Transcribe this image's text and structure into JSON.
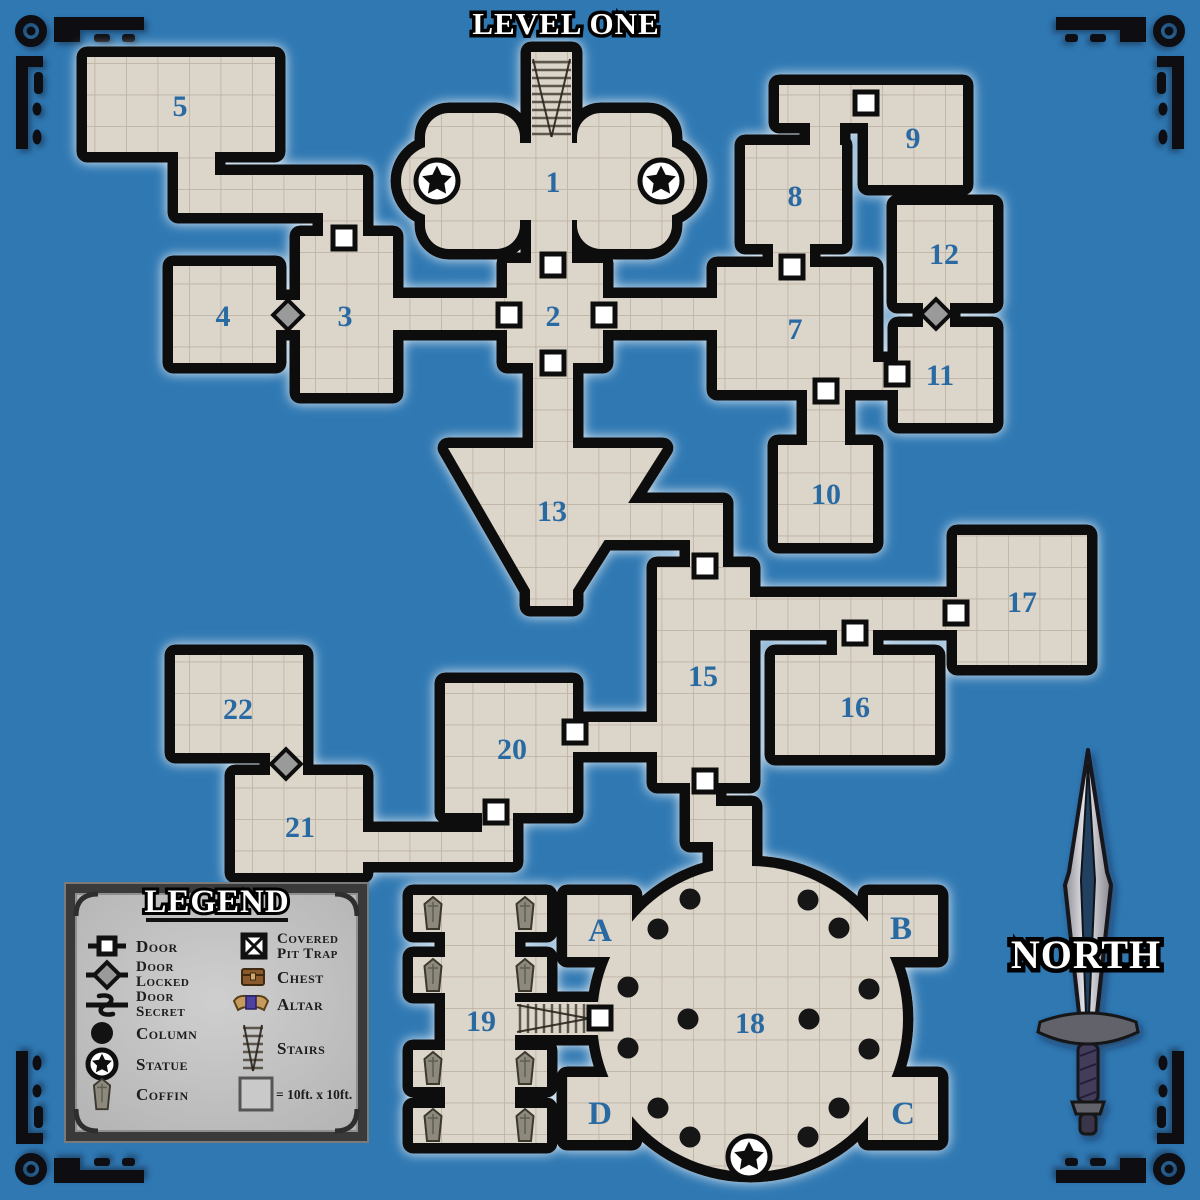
{
  "title": "LEVEL ONE",
  "compass": {
    "label": "NORTH"
  },
  "legend": {
    "title": "LEGEND",
    "items": [
      {
        "name": "door",
        "label": "Door"
      },
      {
        "name": "door-locked",
        "label": "Door Locked",
        "line1": "Door",
        "line2": "Locked"
      },
      {
        "name": "door-secret",
        "label": "Door Secret",
        "line1": "Door",
        "line2": "Secret"
      },
      {
        "name": "column",
        "label": "Column"
      },
      {
        "name": "statue",
        "label": "Statue"
      },
      {
        "name": "coffin",
        "label": "Coffin"
      },
      {
        "name": "covered-pit-trap",
        "label": "Covered Pit Trap",
        "line1": "Covered",
        "line2": "Pit Trap"
      },
      {
        "name": "chest",
        "label": "Chest"
      },
      {
        "name": "altar",
        "label": "Altar"
      },
      {
        "name": "stairs",
        "label": "Stairs"
      },
      {
        "name": "scale",
        "label": "= 10ft. x 10ft."
      }
    ]
  },
  "rooms": {
    "r1": "1",
    "r2": "2",
    "r3": "3",
    "r4": "4",
    "r5": "5",
    "r7": "7",
    "r8": "8",
    "r9": "9",
    "r10": "10",
    "r11": "11",
    "r12": "12",
    "r13": "13",
    "r15": "15",
    "r16": "16",
    "r17": "17",
    "r18": "18",
    "r19": "19",
    "r20": "20",
    "r21": "21",
    "r22": "22",
    "rA": "A",
    "rB": "B",
    "rC": "C",
    "rD": "D"
  },
  "colors": {
    "bg": "#2f78b2",
    "floor": "#dcd5c9",
    "grid": "#b9ae9f",
    "wall": "#111111",
    "room-number": "#2b6ba3",
    "door-fill": "#ffffff",
    "locked-fill": "#9a9a9a",
    "legend-bg": "#c6c6c6",
    "legend-text": "#1d1d1d"
  },
  "map_features": {
    "doors": [
      [
        344,
        238
      ],
      [
        553,
        265
      ],
      [
        509,
        315
      ],
      [
        604,
        315
      ],
      [
        553,
        363
      ],
      [
        792,
        267
      ],
      [
        866,
        103
      ],
      [
        897,
        374
      ],
      [
        826,
        391
      ],
      [
        705,
        566
      ],
      [
        956,
        613
      ],
      [
        855,
        633
      ],
      [
        705,
        781
      ],
      [
        575,
        732
      ],
      [
        496,
        812
      ],
      [
        600,
        1018
      ]
    ],
    "locked_doors": [
      [
        288,
        315
      ],
      [
        936,
        314
      ],
      [
        286,
        764
      ]
    ],
    "columns": [
      [
        690,
        899
      ],
      [
        808,
        900
      ],
      [
        658,
        929
      ],
      [
        839,
        928
      ],
      [
        628,
        987
      ],
      [
        869,
        989
      ],
      [
        688,
        1019
      ],
      [
        809,
        1019
      ],
      [
        628,
        1048
      ],
      [
        869,
        1049
      ],
      [
        658,
        1108
      ],
      [
        839,
        1108
      ],
      [
        690,
        1137
      ],
      [
        808,
        1137
      ]
    ],
    "statues": [
      [
        437,
        181
      ],
      [
        661,
        181
      ],
      [
        749,
        1157
      ]
    ],
    "coffins": [
      [
        433,
        913
      ],
      [
        525,
        913
      ],
      [
        433,
        975
      ],
      [
        525,
        975
      ],
      [
        433,
        1068
      ],
      [
        525,
        1068
      ],
      [
        433,
        1125
      ],
      [
        525,
        1125
      ]
    ],
    "stairs": [
      {
        "x": 531,
        "y": 56,
        "w": 41,
        "h": 84,
        "dir": "down"
      },
      {
        "x": 514,
        "y": 1003,
        "w": 78,
        "h": 31,
        "dir": "right"
      }
    ]
  }
}
